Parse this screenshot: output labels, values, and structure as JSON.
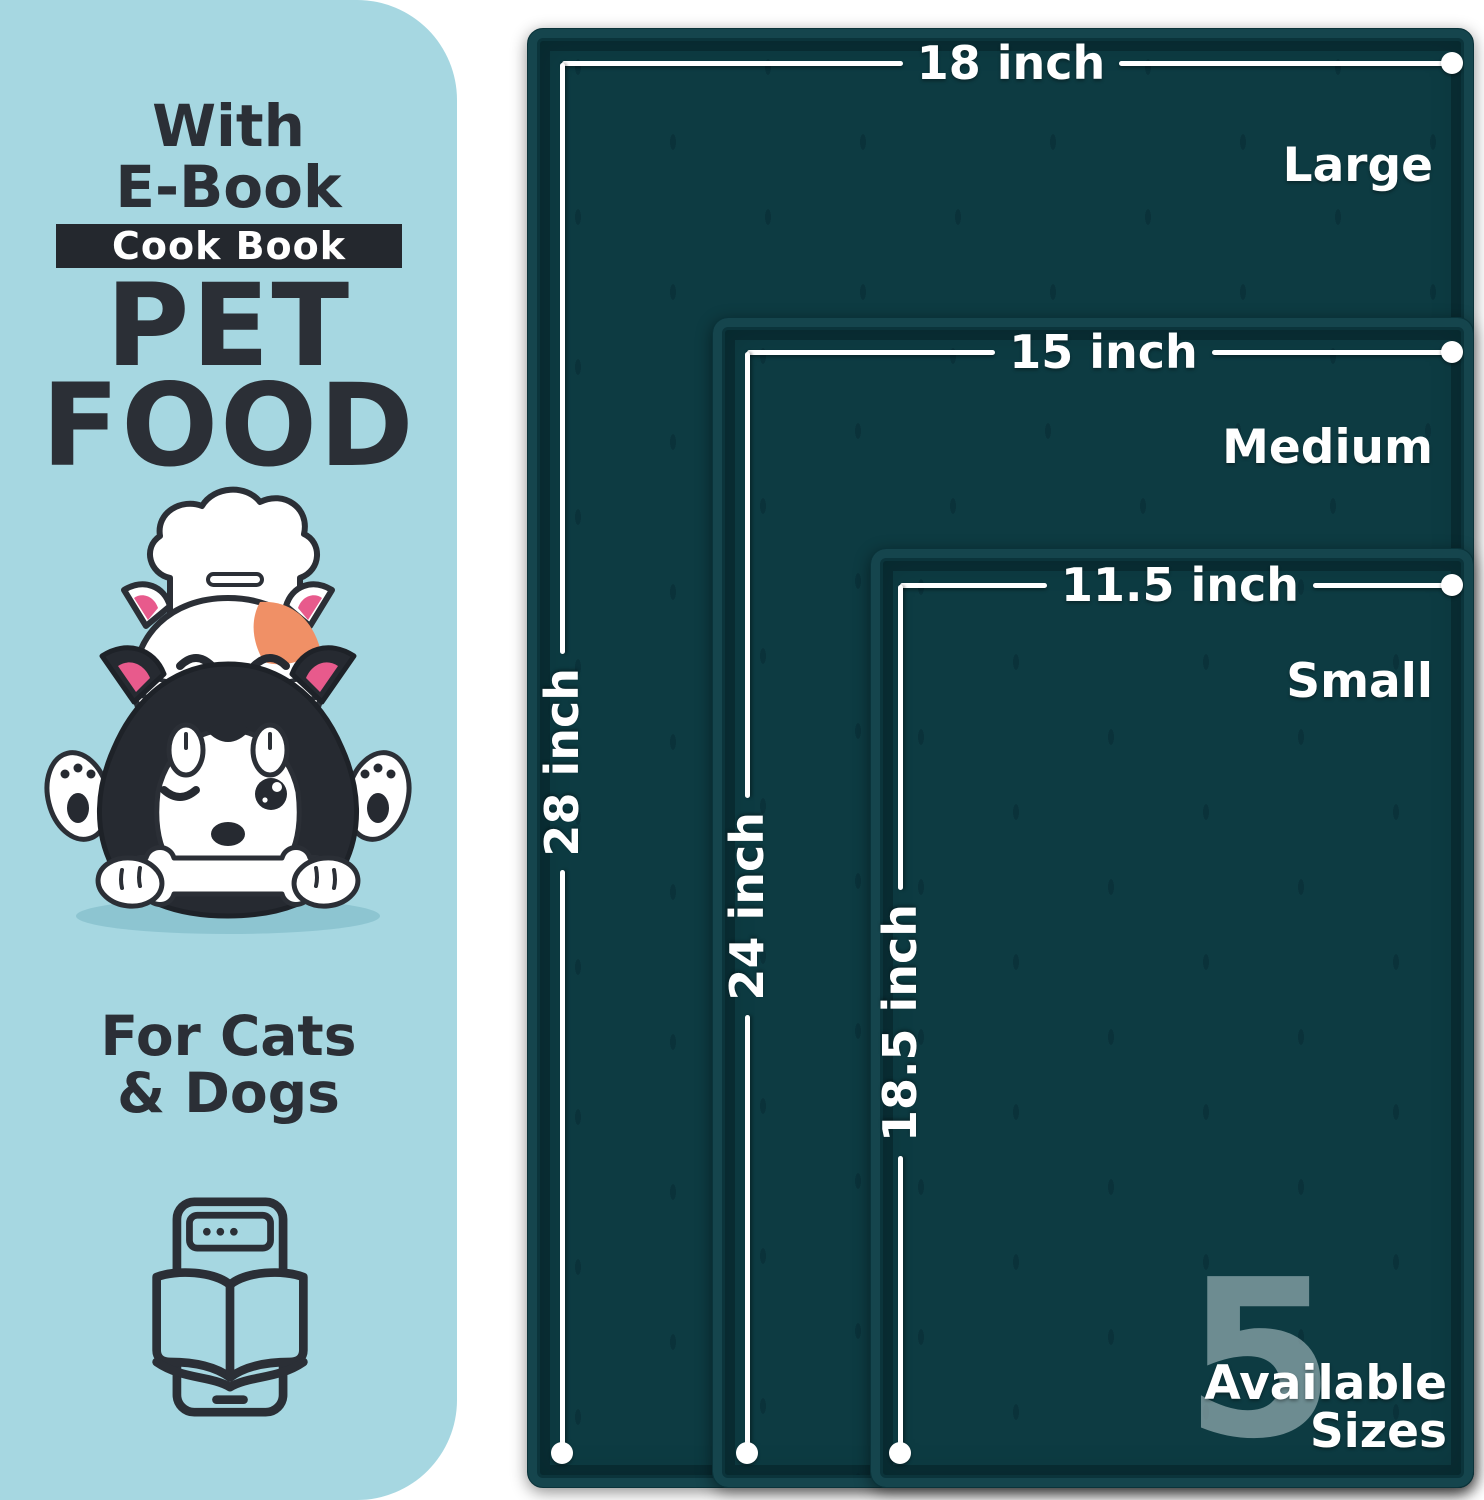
{
  "panel": {
    "intro_line1": "With",
    "intro_line2": "E-Book",
    "badge_label": "Cook Book",
    "title_line1": "PET",
    "title_line2": "FOOD",
    "audience_line1": "For Cats",
    "audience_line2": "& Dogs"
  },
  "mats": {
    "sizes": [
      {
        "name": "Large",
        "width_label": "18 inch",
        "height_label": "28 inch"
      },
      {
        "name": "Medium",
        "width_label": "15 inch",
        "height_label": "24 inch"
      },
      {
        "name": "Small",
        "width_label": "11.5 inch",
        "height_label": "18.5 inch"
      }
    ],
    "availability": {
      "count": "5",
      "line1": "Available",
      "line2": "Sizes"
    }
  },
  "icons": {
    "illustration": "cat-dog-chef-illustration",
    "ebook": "ebook-tablet-icon"
  },
  "colors": {
    "panel_bg": "#a6d7e1",
    "mat_surface": "#0d3b42",
    "mat_rim_highlight": "#15454d",
    "mat_rim_shadow": "#07262c",
    "text_dark": "#2b2f36",
    "badge_bg": "#24282e",
    "annotation_white": "#ffffff",
    "count_tint": "#a8bfc2",
    "cat_patch_orange": "#f09066",
    "ear_pink": "#e85a8c"
  }
}
